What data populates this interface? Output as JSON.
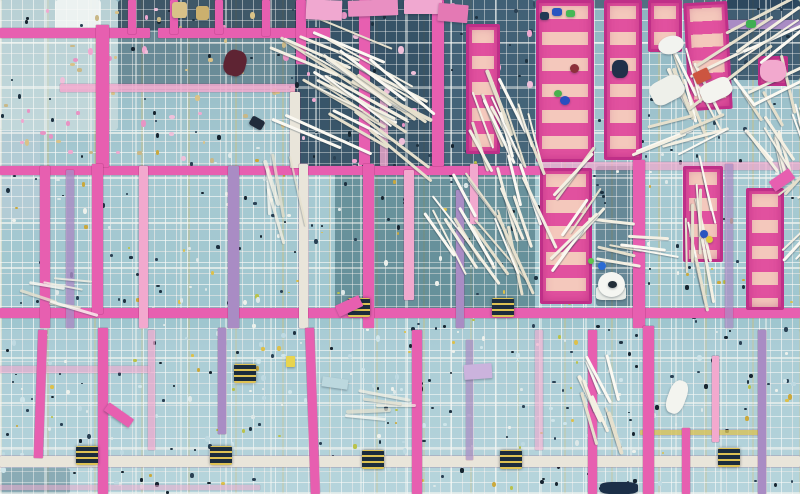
{
  "scene": "Aerial top-down photograph of a building construction site: teal rebar mesh grid, magenta-pink formwork beams and ladder panels, bundles of white poles, scattered debris and tiny workers",
  "palette": {
    "base": "#9cc2cc",
    "pink": "#e75fb0",
    "pinkLight": "#f2a9ce",
    "purple": "#a98cc4",
    "whiteBeam": "#e9e5da",
    "panel": "#e1519f",
    "panelRung": "#f4c8bc",
    "panelEdge": "#bf2f88",
    "stick": "#f4f0e3",
    "yellowLine": "#d8c35a",
    "navy": "#223a50",
    "dark": "#16242f"
  },
  "patches": [
    {
      "x": 0,
      "y": 0,
      "w": 118,
      "h": 130,
      "c": "#dde8e6",
      "o": 0.55
    },
    {
      "x": 55,
      "y": 0,
      "w": 46,
      "h": 36,
      "c": "#f2f5f4",
      "o": 0.9
    },
    {
      "x": 118,
      "y": 0,
      "w": 185,
      "h": 30,
      "c": "#24384a",
      "o": 0.75
    },
    {
      "x": 118,
      "y": 30,
      "w": 180,
      "h": 60,
      "c": "#33505e",
      "o": 0.45
    },
    {
      "x": 295,
      "y": 0,
      "w": 140,
      "h": 168,
      "c": "#1f3a50",
      "o": 0.8
    },
    {
      "x": 435,
      "y": 0,
      "w": 100,
      "h": 168,
      "c": "#27445c",
      "o": 0.75
    },
    {
      "x": 335,
      "y": 168,
      "w": 200,
      "h": 145,
      "c": "#376470",
      "o": 0.55
    },
    {
      "x": 596,
      "y": 166,
      "w": 42,
      "h": 140,
      "c": "#2a4a5e",
      "o": 0.5
    },
    {
      "x": 533,
      "y": 0,
      "w": 267,
      "h": 8,
      "c": "#22384e",
      "o": 0.55
    },
    {
      "x": 726,
      "y": 0,
      "w": 74,
      "h": 80,
      "c": "#1e3850",
      "o": 0.7
    },
    {
      "x": 0,
      "y": 468,
      "w": 70,
      "h": 26,
      "c": "#3a616f",
      "o": 0.5
    },
    {
      "x": 0,
      "y": 330,
      "w": 800,
      "h": 164,
      "c": "#c2dce2",
      "o": 0.28
    },
    {
      "x": 0,
      "y": 130,
      "w": 40,
      "h": 90,
      "c": "#c8d2dc",
      "o": 0.4
    }
  ],
  "speckLayers": [
    {
      "x": 0,
      "y": 0,
      "w": 800,
      "h": 494,
      "n": 320,
      "colors": [
        "#16242f",
        "#2a4154",
        "#1d3140"
      ],
      "min": 2,
      "max": 4
    },
    {
      "x": 0,
      "y": 150,
      "w": 800,
      "h": 340,
      "n": 80,
      "colors": [
        "#ddc04a",
        "#b9c24a",
        "#caa83c"
      ],
      "min": 2,
      "max": 4
    },
    {
      "x": 0,
      "y": 140,
      "w": 800,
      "h": 350,
      "n": 100,
      "colors": [
        "#edf1ec",
        "#dde8e8"
      ],
      "min": 2,
      "max": 4
    },
    {
      "x": 0,
      "y": 0,
      "w": 530,
      "h": 165,
      "n": 50,
      "colors": [
        "#f0a8d0",
        "#e794c4",
        "#efc0da"
      ],
      "min": 3,
      "max": 6
    },
    {
      "x": 0,
      "y": 330,
      "w": 800,
      "h": 160,
      "n": 70,
      "colors": [
        "#cfe5ea",
        "#bfdae2"
      ],
      "min": 3,
      "max": 5
    },
    {
      "x": 0,
      "y": 0,
      "w": 300,
      "h": 160,
      "n": 30,
      "colors": [
        "#d9c288",
        "#c9b887"
      ],
      "min": 2,
      "max": 5
    }
  ],
  "hbeams": [
    {
      "x": 0,
      "y": 28,
      "w": 150,
      "h": 10,
      "c": "pink"
    },
    {
      "x": 158,
      "y": 28,
      "w": 172,
      "h": 10,
      "c": "pink"
    },
    {
      "x": 60,
      "y": 84,
      "w": 235,
      "h": 8,
      "c": "pinkLight",
      "o": 0.85
    },
    {
      "x": 0,
      "y": 166,
      "w": 540,
      "h": 9,
      "c": "pink"
    },
    {
      "x": 540,
      "y": 162,
      "w": 260,
      "h": 8,
      "c": "pinkLight",
      "o": 0.7
    },
    {
      "x": 0,
      "y": 308,
      "w": 800,
      "h": 10,
      "c": "pink"
    },
    {
      "x": 0,
      "y": 366,
      "w": 150,
      "h": 7,
      "c": "pinkLight",
      "o": 0.6
    },
    {
      "x": 0,
      "y": 456,
      "w": 800,
      "h": 11,
      "c": "whiteBeam"
    },
    {
      "x": 726,
      "y": 20,
      "w": 74,
      "h": 9,
      "c": "purple"
    },
    {
      "x": 640,
      "y": 430,
      "w": 120,
      "h": 5,
      "c": "yellowLine",
      "o": 0.8
    },
    {
      "x": 0,
      "y": 485,
      "w": 260,
      "h": 5,
      "c": "pinkLight",
      "o": 0.5
    }
  ],
  "vbeams": [
    {
      "x": 96,
      "y": 25,
      "w": 13,
      "h": 142,
      "c": "pink"
    },
    {
      "x": 128,
      "y": 0,
      "w": 8,
      "h": 34,
      "c": "pink"
    },
    {
      "x": 170,
      "y": 0,
      "w": 8,
      "h": 34,
      "c": "pink"
    },
    {
      "x": 215,
      "y": 0,
      "w": 8,
      "h": 34,
      "c": "pink"
    },
    {
      "x": 262,
      "y": 0,
      "w": 8,
      "h": 36,
      "c": "pink"
    },
    {
      "x": 296,
      "y": 0,
      "w": 10,
      "h": 64,
      "c": "pink"
    },
    {
      "x": 359,
      "y": 0,
      "w": 11,
      "h": 165,
      "c": "pink"
    },
    {
      "x": 432,
      "y": 0,
      "w": 12,
      "h": 166,
      "c": "pink"
    },
    {
      "x": 290,
      "y": 92,
      "w": 10,
      "h": 76,
      "c": "whiteBeam"
    },
    {
      "x": 380,
      "y": 96,
      "w": 8,
      "h": 70,
      "c": "pinkLight",
      "o": 0.8
    },
    {
      "x": 40,
      "y": 166,
      "w": 10,
      "h": 162,
      "c": "pink"
    },
    {
      "x": 66,
      "y": 170,
      "w": 8,
      "h": 158,
      "c": "purple",
      "o": 0.8
    },
    {
      "x": 92,
      "y": 164,
      "w": 11,
      "h": 150,
      "c": "pink"
    },
    {
      "x": 139,
      "y": 166,
      "w": 9,
      "h": 162,
      "c": "pinkLight"
    },
    {
      "x": 228,
      "y": 166,
      "w": 11,
      "h": 162,
      "c": "purple"
    },
    {
      "x": 299,
      "y": 164,
      "w": 9,
      "h": 164,
      "c": "whiteBeam"
    },
    {
      "x": 363,
      "y": 164,
      "w": 11,
      "h": 164,
      "c": "pink"
    },
    {
      "x": 404,
      "y": 170,
      "w": 10,
      "h": 130,
      "c": "pinkLight"
    },
    {
      "x": 456,
      "y": 190,
      "w": 8,
      "h": 138,
      "c": "purple"
    },
    {
      "x": 470,
      "y": 164,
      "w": 8,
      "h": 60,
      "c": "pinkLight"
    },
    {
      "x": 633,
      "y": 160,
      "w": 12,
      "h": 168,
      "c": "pink"
    },
    {
      "x": 725,
      "y": 164,
      "w": 8,
      "h": 164,
      "c": "purple",
      "o": 0.7
    },
    {
      "x": 36,
      "y": 330,
      "w": 9,
      "h": 128,
      "c": "pink",
      "r": 2
    },
    {
      "x": 98,
      "y": 328,
      "w": 10,
      "h": 166,
      "c": "pink"
    },
    {
      "x": 148,
      "y": 330,
      "w": 7,
      "h": 120,
      "c": "pinkLight",
      "o": 0.7
    },
    {
      "x": 218,
      "y": 328,
      "w": 8,
      "h": 106,
      "c": "purple"
    },
    {
      "x": 308,
      "y": 328,
      "w": 9,
      "h": 166,
      "c": "pink",
      "r": -2
    },
    {
      "x": 412,
      "y": 330,
      "w": 10,
      "h": 164,
      "c": "pink"
    },
    {
      "x": 466,
      "y": 340,
      "w": 7,
      "h": 120,
      "c": "purple",
      "o": 0.7
    },
    {
      "x": 535,
      "y": 330,
      "w": 8,
      "h": 120,
      "c": "pinkLight",
      "o": 0.6
    },
    {
      "x": 588,
      "y": 330,
      "w": 9,
      "h": 164,
      "c": "pink"
    },
    {
      "x": 643,
      "y": 326,
      "w": 11,
      "h": 168,
      "c": "pink"
    },
    {
      "x": 682,
      "y": 428,
      "w": 8,
      "h": 66,
      "c": "pink"
    },
    {
      "x": 712,
      "y": 356,
      "w": 7,
      "h": 86,
      "c": "pinkLight"
    },
    {
      "x": 758,
      "y": 330,
      "w": 8,
      "h": 164,
      "c": "purple"
    }
  ],
  "panels": [
    {
      "x": 536,
      "y": 0,
      "w": 58,
      "h": 162
    },
    {
      "x": 604,
      "y": 0,
      "w": 38,
      "h": 160
    },
    {
      "x": 466,
      "y": 24,
      "w": 34,
      "h": 130
    },
    {
      "x": 648,
      "y": 0,
      "w": 34,
      "h": 52
    },
    {
      "x": 686,
      "y": 2,
      "w": 44,
      "h": 108,
      "r": -3
    },
    {
      "x": 758,
      "y": 56,
      "w": 30,
      "h": 30
    },
    {
      "x": 540,
      "y": 168,
      "w": 52,
      "h": 136
    },
    {
      "x": 683,
      "y": 166,
      "w": 40,
      "h": 96
    },
    {
      "x": 746,
      "y": 188,
      "w": 38,
      "h": 122
    }
  ],
  "blocks": [
    {
      "x": 348,
      "y": 298
    },
    {
      "x": 492,
      "y": 298
    },
    {
      "x": 76,
      "y": 446
    },
    {
      "x": 210,
      "y": 446
    },
    {
      "x": 362,
      "y": 450
    },
    {
      "x": 500,
      "y": 450
    },
    {
      "x": 718,
      "y": 448
    },
    {
      "x": 234,
      "y": 364
    }
  ],
  "bundles": [
    {
      "x": 266,
      "y": 28,
      "w": 70,
      "h": 110,
      "a": 28,
      "n": 20,
      "l": 85
    },
    {
      "x": 300,
      "y": 70,
      "w": 60,
      "h": 95,
      "a": 33,
      "n": 14,
      "l": 80
    },
    {
      "x": 450,
      "y": 92,
      "w": 70,
      "h": 65,
      "a": 68,
      "n": 14,
      "l": 60
    },
    {
      "x": 413,
      "y": 185,
      "w": 50,
      "h": 70,
      "a": 55,
      "n": 13,
      "l": 65
    },
    {
      "x": 464,
      "y": 172,
      "w": 38,
      "h": 100,
      "a": 72,
      "n": 10,
      "l": 70
    },
    {
      "x": 588,
      "y": 212,
      "w": 46,
      "h": 50,
      "a": 8,
      "n": 7,
      "l": 42
    },
    {
      "x": 653,
      "y": 172,
      "w": 34,
      "h": 115,
      "a": 83,
      "n": 11,
      "l": 58
    },
    {
      "x": 754,
      "y": 76,
      "w": 46,
      "h": 88,
      "a": 75,
      "n": 13,
      "l": 55
    },
    {
      "x": 726,
      "y": 90,
      "w": 32,
      "h": 64,
      "a": 55,
      "n": 7,
      "l": 45
    },
    {
      "x": 645,
      "y": 54,
      "w": 40,
      "h": 58,
      "a": 70,
      "n": 9,
      "l": 48
    },
    {
      "x": 676,
      "y": 8,
      "w": 86,
      "h": 84,
      "a": -32,
      "n": 10,
      "l": 85
    },
    {
      "x": 628,
      "y": 104,
      "w": 52,
      "h": 40,
      "a": -22,
      "n": 6,
      "l": 60
    },
    {
      "x": 558,
      "y": 376,
      "w": 48,
      "h": 56,
      "a": 70,
      "n": 9,
      "l": 45
    },
    {
      "x": 533,
      "y": 166,
      "w": 26,
      "h": 84,
      "a": -48,
      "n": 7,
      "l": 55
    },
    {
      "x": 772,
      "y": 166,
      "w": 28,
      "h": 82,
      "a": -40,
      "n": 7,
      "l": 55
    },
    {
      "x": 235,
      "y": 172,
      "w": 30,
      "h": 95,
      "a": 80,
      "n": 5,
      "l": 60,
      "op": 0.75
    },
    {
      "x": 330,
      "y": 392,
      "w": 60,
      "h": 26,
      "a": 5,
      "n": 5,
      "l": 45,
      "op": 0.7
    },
    {
      "x": 8,
      "y": 268,
      "w": 55,
      "h": 40,
      "a": 12,
      "n": 6,
      "l": 40,
      "op": 0.8
    }
  ],
  "objects": [
    {
      "nm": "maroon-tarp",
      "x": 224,
      "y": 50,
      "w": 22,
      "h": 26,
      "c": "#5e2433",
      "br": 40,
      "r": 15
    },
    {
      "nm": "wood-crate",
      "x": 172,
      "y": 2,
      "w": 15,
      "h": 16,
      "c": "#d9c288",
      "br": 20
    },
    {
      "nm": "wood-crate",
      "x": 196,
      "y": 6,
      "w": 13,
      "h": 14,
      "c": "#cbb06e",
      "br": 20
    },
    {
      "nm": "pink-panel-piece",
      "x": 306,
      "y": 0,
      "w": 36,
      "h": 20,
      "c": "#f0a8d0",
      "br": 4,
      "r": 2
    },
    {
      "nm": "pink-panel-piece",
      "x": 348,
      "y": 0,
      "w": 50,
      "h": 16,
      "c": "#e98fc2",
      "br": 4,
      "r": -2
    },
    {
      "nm": "pink-panel-piece",
      "x": 404,
      "y": 0,
      "w": 38,
      "h": 14,
      "c": "#f0a8d0",
      "br": 4
    },
    {
      "nm": "pink-panel-piece",
      "x": 438,
      "y": 4,
      "w": 30,
      "h": 18,
      "c": "#e479b4",
      "br": 4,
      "r": 5
    },
    {
      "nm": "safety-helmet",
      "x": 658,
      "y": 36,
      "w": 26,
      "h": 18,
      "c": "#f2f3ef",
      "br": 50,
      "r": -15
    },
    {
      "nm": "white-tub",
      "x": 650,
      "y": 78,
      "w": 34,
      "h": 24,
      "c": "#eef0ea",
      "br": 30,
      "r": -28
    },
    {
      "nm": "red-block",
      "x": 694,
      "y": 70,
      "w": 16,
      "h": 12,
      "c": "#cc5540",
      "br": 10,
      "r": -25
    },
    {
      "nm": "white-tub",
      "x": 700,
      "y": 80,
      "w": 32,
      "h": 20,
      "c": "#f4f4ef",
      "br": 30,
      "r": -25
    },
    {
      "nm": "pink-tarp",
      "x": 760,
      "y": 60,
      "w": 26,
      "h": 22,
      "c": "#f2a9ce",
      "br": 40
    },
    {
      "nm": "dark-helmet",
      "x": 612,
      "y": 60,
      "w": 16,
      "h": 18,
      "c": "#20304a",
      "br": 40
    },
    {
      "nm": "worker",
      "x": 560,
      "y": 96,
      "w": 10,
      "h": 9,
      "c": "#2a4ec0",
      "br": 50
    },
    {
      "nm": "worker",
      "x": 554,
      "y": 90,
      "w": 8,
      "h": 7,
      "c": "#49b04e",
      "br": 50
    },
    {
      "nm": "worker",
      "x": 570,
      "y": 64,
      "w": 9,
      "h": 9,
      "c": "#8c2f3a",
      "br": 50
    },
    {
      "nm": "worker",
      "x": 540,
      "y": 12,
      "w": 9,
      "h": 8,
      "c": "#223a55",
      "br": 30
    },
    {
      "nm": "worker",
      "x": 552,
      "y": 8,
      "w": 10,
      "h": 8,
      "c": "#2a55c0",
      "br": 30
    },
    {
      "nm": "worker",
      "x": 566,
      "y": 10,
      "w": 9,
      "h": 7,
      "c": "#45b855",
      "br": 30
    },
    {
      "nm": "green-bit",
      "x": 746,
      "y": 20,
      "w": 10,
      "h": 8,
      "c": "#3fae52",
      "br": 30
    },
    {
      "nm": "debris",
      "x": 250,
      "y": 118,
      "w": 14,
      "h": 10,
      "c": "#202c3c",
      "br": 20,
      "r": 30
    },
    {
      "nm": "mixer-base",
      "x": 596,
      "y": 286,
      "w": 30,
      "h": 14,
      "c": "#e8ebe6",
      "br": 20
    },
    {
      "nm": "mixer-fan",
      "x": 598,
      "y": 272,
      "w": 27,
      "h": 25,
      "c": "#f5f6f2",
      "br": 50
    },
    {
      "nm": "mixer-hub",
      "x": 608,
      "y": 281,
      "w": 9,
      "h": 7,
      "c": "#222e38",
      "br": 50
    },
    {
      "nm": "worker",
      "x": 598,
      "y": 262,
      "w": 8,
      "h": 8,
      "c": "#2a6bd4",
      "br": 50
    },
    {
      "nm": "worker",
      "x": 588,
      "y": 258,
      "w": 6,
      "h": 6,
      "c": "#5fc24e",
      "br": 50
    },
    {
      "nm": "worker",
      "x": 700,
      "y": 230,
      "w": 8,
      "h": 8,
      "c": "#2a55c0",
      "br": 50
    },
    {
      "nm": "worker",
      "x": 706,
      "y": 236,
      "w": 7,
      "h": 7,
      "c": "#e0c93e",
      "br": 50
    },
    {
      "nm": "purple-sign",
      "x": 464,
      "y": 364,
      "w": 28,
      "h": 15,
      "c": "#cbb3dd",
      "br": 5,
      "r": -4
    },
    {
      "nm": "yellow-note",
      "x": 286,
      "y": 356,
      "w": 9,
      "h": 11,
      "c": "#e8d44e",
      "br": 10
    },
    {
      "nm": "white-hose",
      "x": 668,
      "y": 380,
      "w": 18,
      "h": 34,
      "c": "#f3f4ef",
      "br": 40,
      "r": 20
    },
    {
      "nm": "navy-tarp",
      "x": 600,
      "y": 482,
      "w": 38,
      "h": 12,
      "c": "#1c2f48",
      "br": 30
    },
    {
      "nm": "pink-piece",
      "x": 104,
      "y": 410,
      "w": 30,
      "h": 10,
      "c": "#e75fb0",
      "br": 4,
      "r": 35
    },
    {
      "nm": "pink-piece",
      "x": 336,
      "y": 300,
      "w": 26,
      "h": 12,
      "c": "#e75fb0",
      "br": 4,
      "r": -25
    },
    {
      "nm": "pink-piece",
      "x": 770,
      "y": 174,
      "w": 24,
      "h": 12,
      "c": "#e75fb0",
      "br": 3,
      "r": -35
    },
    {
      "nm": "blue-board",
      "x": 322,
      "y": 378,
      "w": 26,
      "h": 10,
      "c": "#bcd8de",
      "br": 3,
      "r": 8
    }
  ]
}
